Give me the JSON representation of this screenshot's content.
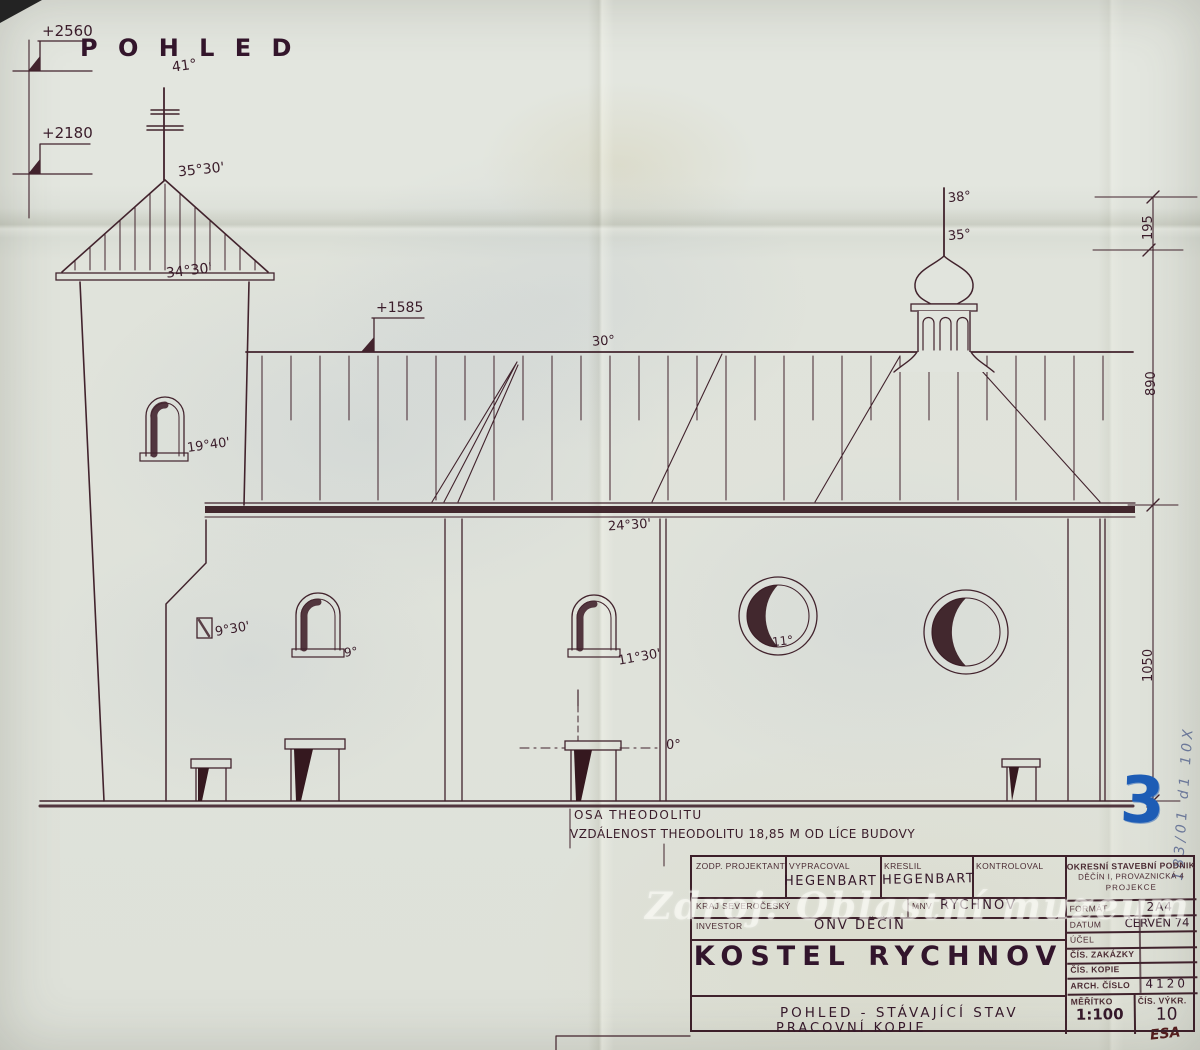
{
  "drawing": {
    "title": "P O H L E D",
    "elevation_marks": {
      "m2560": "+2560",
      "m2180": "+2180",
      "m1585": "+1585"
    },
    "angles": {
      "a41": "41°",
      "a3530": "35°30'",
      "a3430": "34°30'",
      "a1940": "19°40'",
      "a30": "30°",
      "a2430": "24°30'",
      "a930": "9°30'",
      "a9": "9°",
      "a1130": "11°30'",
      "a11": "11°",
      "a38": "38°",
      "a35": "35°",
      "a0": "0°"
    },
    "dimensions": {
      "d195": "195",
      "d890": "890",
      "d1050": "1050"
    },
    "notes": {
      "axis": "OSA THEODOLITU",
      "distance": "VZDÁLENOST THEODOLITU 18,85 M OD LÍCE BUDOVY"
    }
  },
  "marks": {
    "page_number": "3",
    "archive_note": "183/01 d1 10X",
    "signature": "ESA"
  },
  "watermark": "Zdroj: Oblastní muzeum v Děčíně",
  "title_block": {
    "fields": {
      "zodp_projektant_label": "ZODP. PROJEKTANT",
      "vypracoval_label": "VYPRACOVAL",
      "vypracoval_value": "HEGENBART",
      "kreslil_label": "KRESLIL",
      "kreslil_value": "HEGENBART",
      "kontroloval_label": "KONTROLOVAL",
      "kraj_label": "KRAJ SEVEROČESKÝ",
      "mnv_label": "MNV",
      "mnv_value": "RYCHNOV",
      "investor_label": "INVESTOR",
      "investor_value": "ONV DĚČÍN"
    },
    "project_title": "KOSTEL RYCHNOV",
    "subtitle_line1": "POHLED - STÁVAJÍCÍ STAV",
    "subtitle_line2": "PRACOVNÍ KOPIE",
    "stamp": {
      "company_line1": "OKRESNÍ STAVEBNÍ PODNIK",
      "company_line2": "DĚČÍN I, PROVAZNICKÁ 4",
      "company_line3": "PROJEKCE",
      "rows": [
        {
          "label": "FORMÁT",
          "value": "2A4"
        },
        {
          "label": "DATUM",
          "value": "ČERVEN 74"
        },
        {
          "label": "ÚČEL",
          "value": ""
        },
        {
          "label": "ČÍS. ZAKÁZKY",
          "value": ""
        },
        {
          "label": "ČÍS. KOPIE",
          "value": ""
        },
        {
          "label": "ARCH. ČÍSLO",
          "value": "4120"
        }
      ],
      "meritko_label": "MĚŘÍTKO",
      "meritko_value": "1:100",
      "cis_vykr_label": "ČÍS. VÝKR.",
      "cis_vykr_value": "10"
    }
  }
}
